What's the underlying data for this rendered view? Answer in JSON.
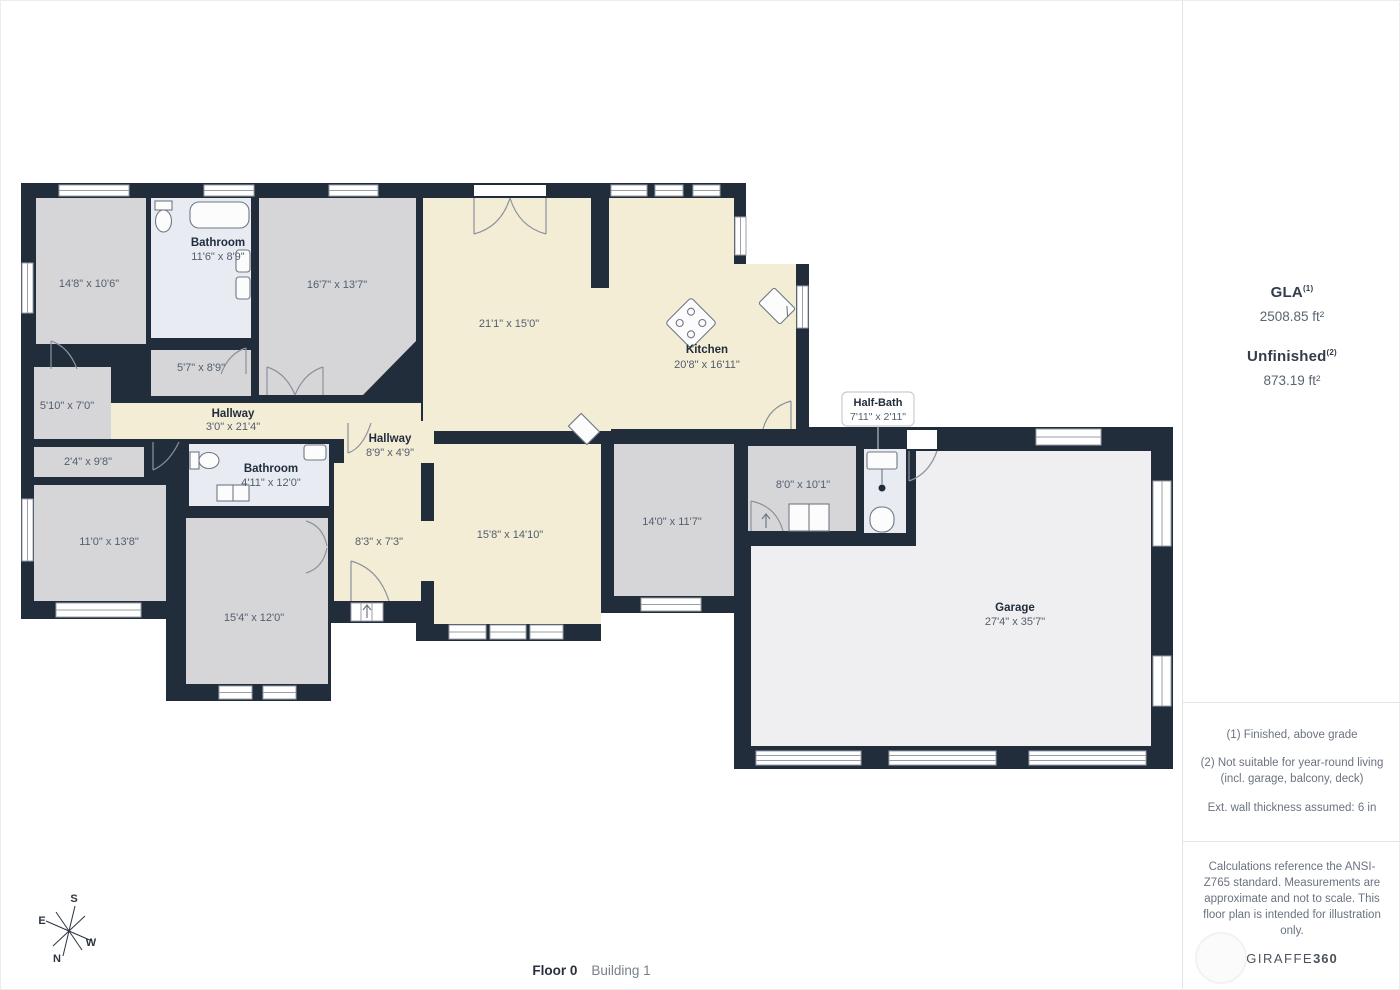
{
  "colors": {
    "wall": "#222d3c",
    "room_gray": "#d6d6d8",
    "room_cream": "#f3edd6",
    "room_bath": "#e8ecf2",
    "room_garage": "#efeff1",
    "window_line": "#9aa0a8",
    "door_line": "#8b929c"
  },
  "floorplan": {
    "rooms": {
      "room1": {
        "dims": "14'8\" x 10'6\""
      },
      "bathroom_top": {
        "name": "Bathroom",
        "dims": "11'6\" x 8'9\""
      },
      "room167": {
        "dims": "16'7\" x 13'7\""
      },
      "living": {
        "dims": "21'1\" x 15'0\""
      },
      "kitchen": {
        "name": "Kitchen",
        "dims": "20'8\" x 16'11\""
      },
      "room57": {
        "dims": "5'7\" x 8'9\""
      },
      "room510": {
        "dims": "5'10\" x 7'0\""
      },
      "hallway1": {
        "name": "Hallway",
        "dims": "3'0\" x 21'4\""
      },
      "closet24": {
        "dims": "2'4\" x 9'8\""
      },
      "bathroom_mid": {
        "name": "Bathroom",
        "dims": "4'11\" x 12'0\""
      },
      "room110": {
        "dims": "11'0\" x 13'8\""
      },
      "hallway2": {
        "name": "Hallway",
        "dims": "8'9\" x 4'9\""
      },
      "room83": {
        "dims": "8'3\" x 7'3\""
      },
      "room158": {
        "dims": "15'8\" x 14'10\""
      },
      "room154": {
        "dims": "15'4\" x 12'0\""
      },
      "room140": {
        "dims": "14'0\" x 11'7\""
      },
      "room80": {
        "dims": "8'0\" x 10'1\""
      },
      "halfbath": {
        "name": "Half-Bath",
        "dims": "7'11\" x 2'11\""
      },
      "garage": {
        "name": "Garage",
        "dims": "27'4\" x 35'7\""
      }
    },
    "compass": {
      "n": "N",
      "s": "S",
      "e": "E",
      "w": "W"
    }
  },
  "sidebar": {
    "gla": {
      "label": "GLA",
      "sup": "(1)",
      "value": "2508.85 ft²"
    },
    "unfinished": {
      "label": "Unfinished",
      "sup": "(2)",
      "value": "873.19 ft²"
    },
    "footnotes": {
      "n1": "(1) Finished, above grade",
      "n2": "(2) Not suitable for year-round living (incl. garage, balcony, deck)",
      "n3": "Ext. wall thickness assumed: 6 in"
    },
    "disclaimer": "Calculations reference the ANSI-Z765 standard. Measurements are approximate and not to scale. This floor plan is intended for illustration only.",
    "logo": {
      "part1": "GIRAFFE",
      "part2": "360"
    }
  },
  "footer": {
    "floor_label": "Floor 0",
    "building_label": "Building 1"
  }
}
